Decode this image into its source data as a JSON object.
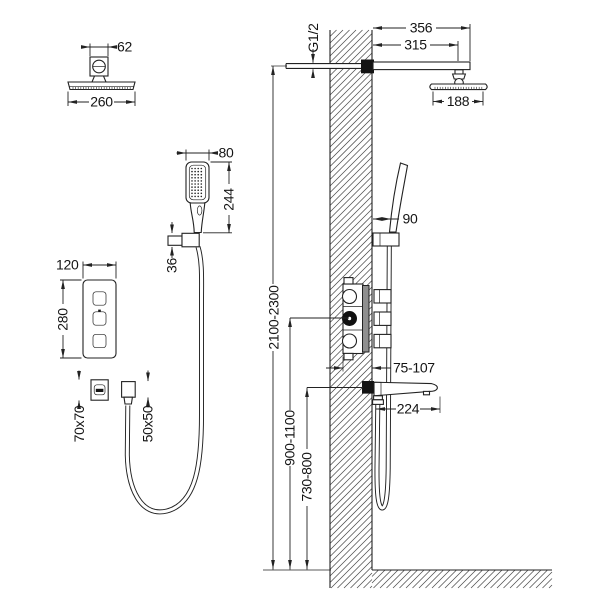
{
  "page": {
    "background": "#ffffff",
    "line_color": "#222222"
  },
  "diagram": {
    "type": "technical-installation-drawing",
    "subject": "concealed shower system: rain head, hand shower, bath spout, 3-function valve",
    "views": {
      "rain_head_front": {
        "mount_width": "62",
        "head_width": "260"
      },
      "rain_head_side": {
        "arm_reach_total": "356",
        "arm_reach_to_center": "315",
        "head_depth": "188",
        "inlet_thread": "G1/2"
      },
      "hand_shower_front": {
        "head_width": "80",
        "overall_height": "244",
        "holder_height": "36"
      },
      "valve_front": {
        "plate_width": "120",
        "plate_height": "280"
      },
      "spout_escutcheon_front": {
        "size": "70x70"
      },
      "hose_outlet_front": {
        "size": "50x50"
      },
      "hand_shower_side": {
        "wall_offset": "90"
      },
      "valve_side": {
        "recess_depth": "75-107"
      },
      "spout_side": {
        "reach": "224"
      },
      "installation_heights": {
        "rain_head_arm": "2100-2300",
        "valve_center": "900-1100",
        "spout": "730-800"
      }
    }
  }
}
